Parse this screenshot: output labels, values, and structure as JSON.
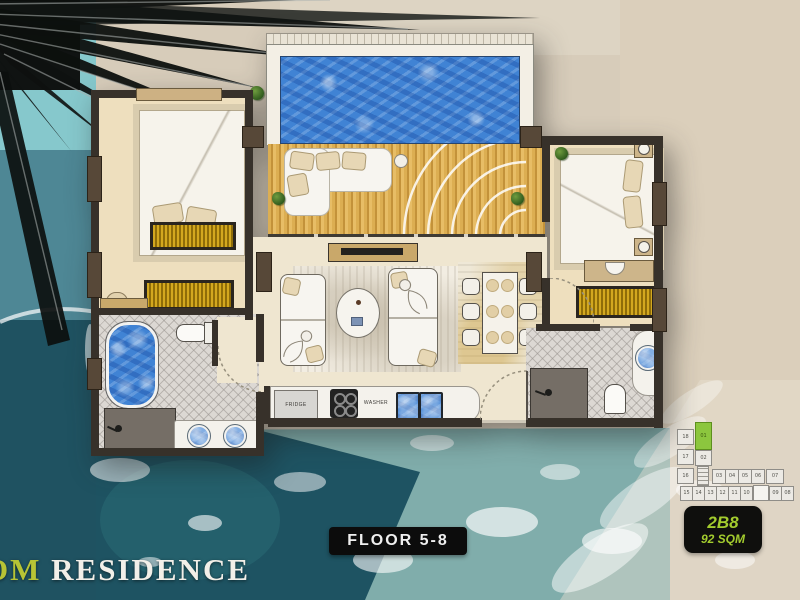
{
  "brand": {
    "prefix": "OM",
    "name": "RESIDENCE"
  },
  "floor_badge": {
    "label": "FLOOR 5-8"
  },
  "unit_badge": {
    "code": "2B8",
    "area": "92 SQM"
  },
  "plan": {
    "fridge_label": "FRIDGE",
    "washer_label": "WASHER",
    "rooms": [
      "master-bedroom",
      "second-bedroom",
      "living-room",
      "dining-area",
      "kitchen",
      "bathroom-left",
      "bathroom-right",
      "balcony-deck",
      "private-pool"
    ]
  },
  "keyplan": {
    "highlighted_unit": "01",
    "highlight_color": "#8cc63e",
    "left_column": [
      "18",
      "17",
      "16"
    ],
    "inner_column": [
      "01",
      "02"
    ],
    "top_row": [
      "03",
      "04",
      "05",
      "06",
      "07"
    ],
    "bottom_row": [
      "15",
      "14",
      "13",
      "12",
      "11",
      "10",
      "09",
      "08"
    ]
  },
  "icons": {
    "plant": "foliage-cluster",
    "shower": "shower-head",
    "stairs": "stair-lines"
  },
  "colors": {
    "accent_green": "#a3cc2e",
    "badge_bg": "#0f0f0d",
    "wall": "#37312a",
    "floor_cream": "#eedfbe",
    "water_blue": "#4083d4",
    "deck_gold": "#d2a449",
    "tile_gray": "#dcd8d3",
    "ocean_teal": "#1e5362"
  }
}
